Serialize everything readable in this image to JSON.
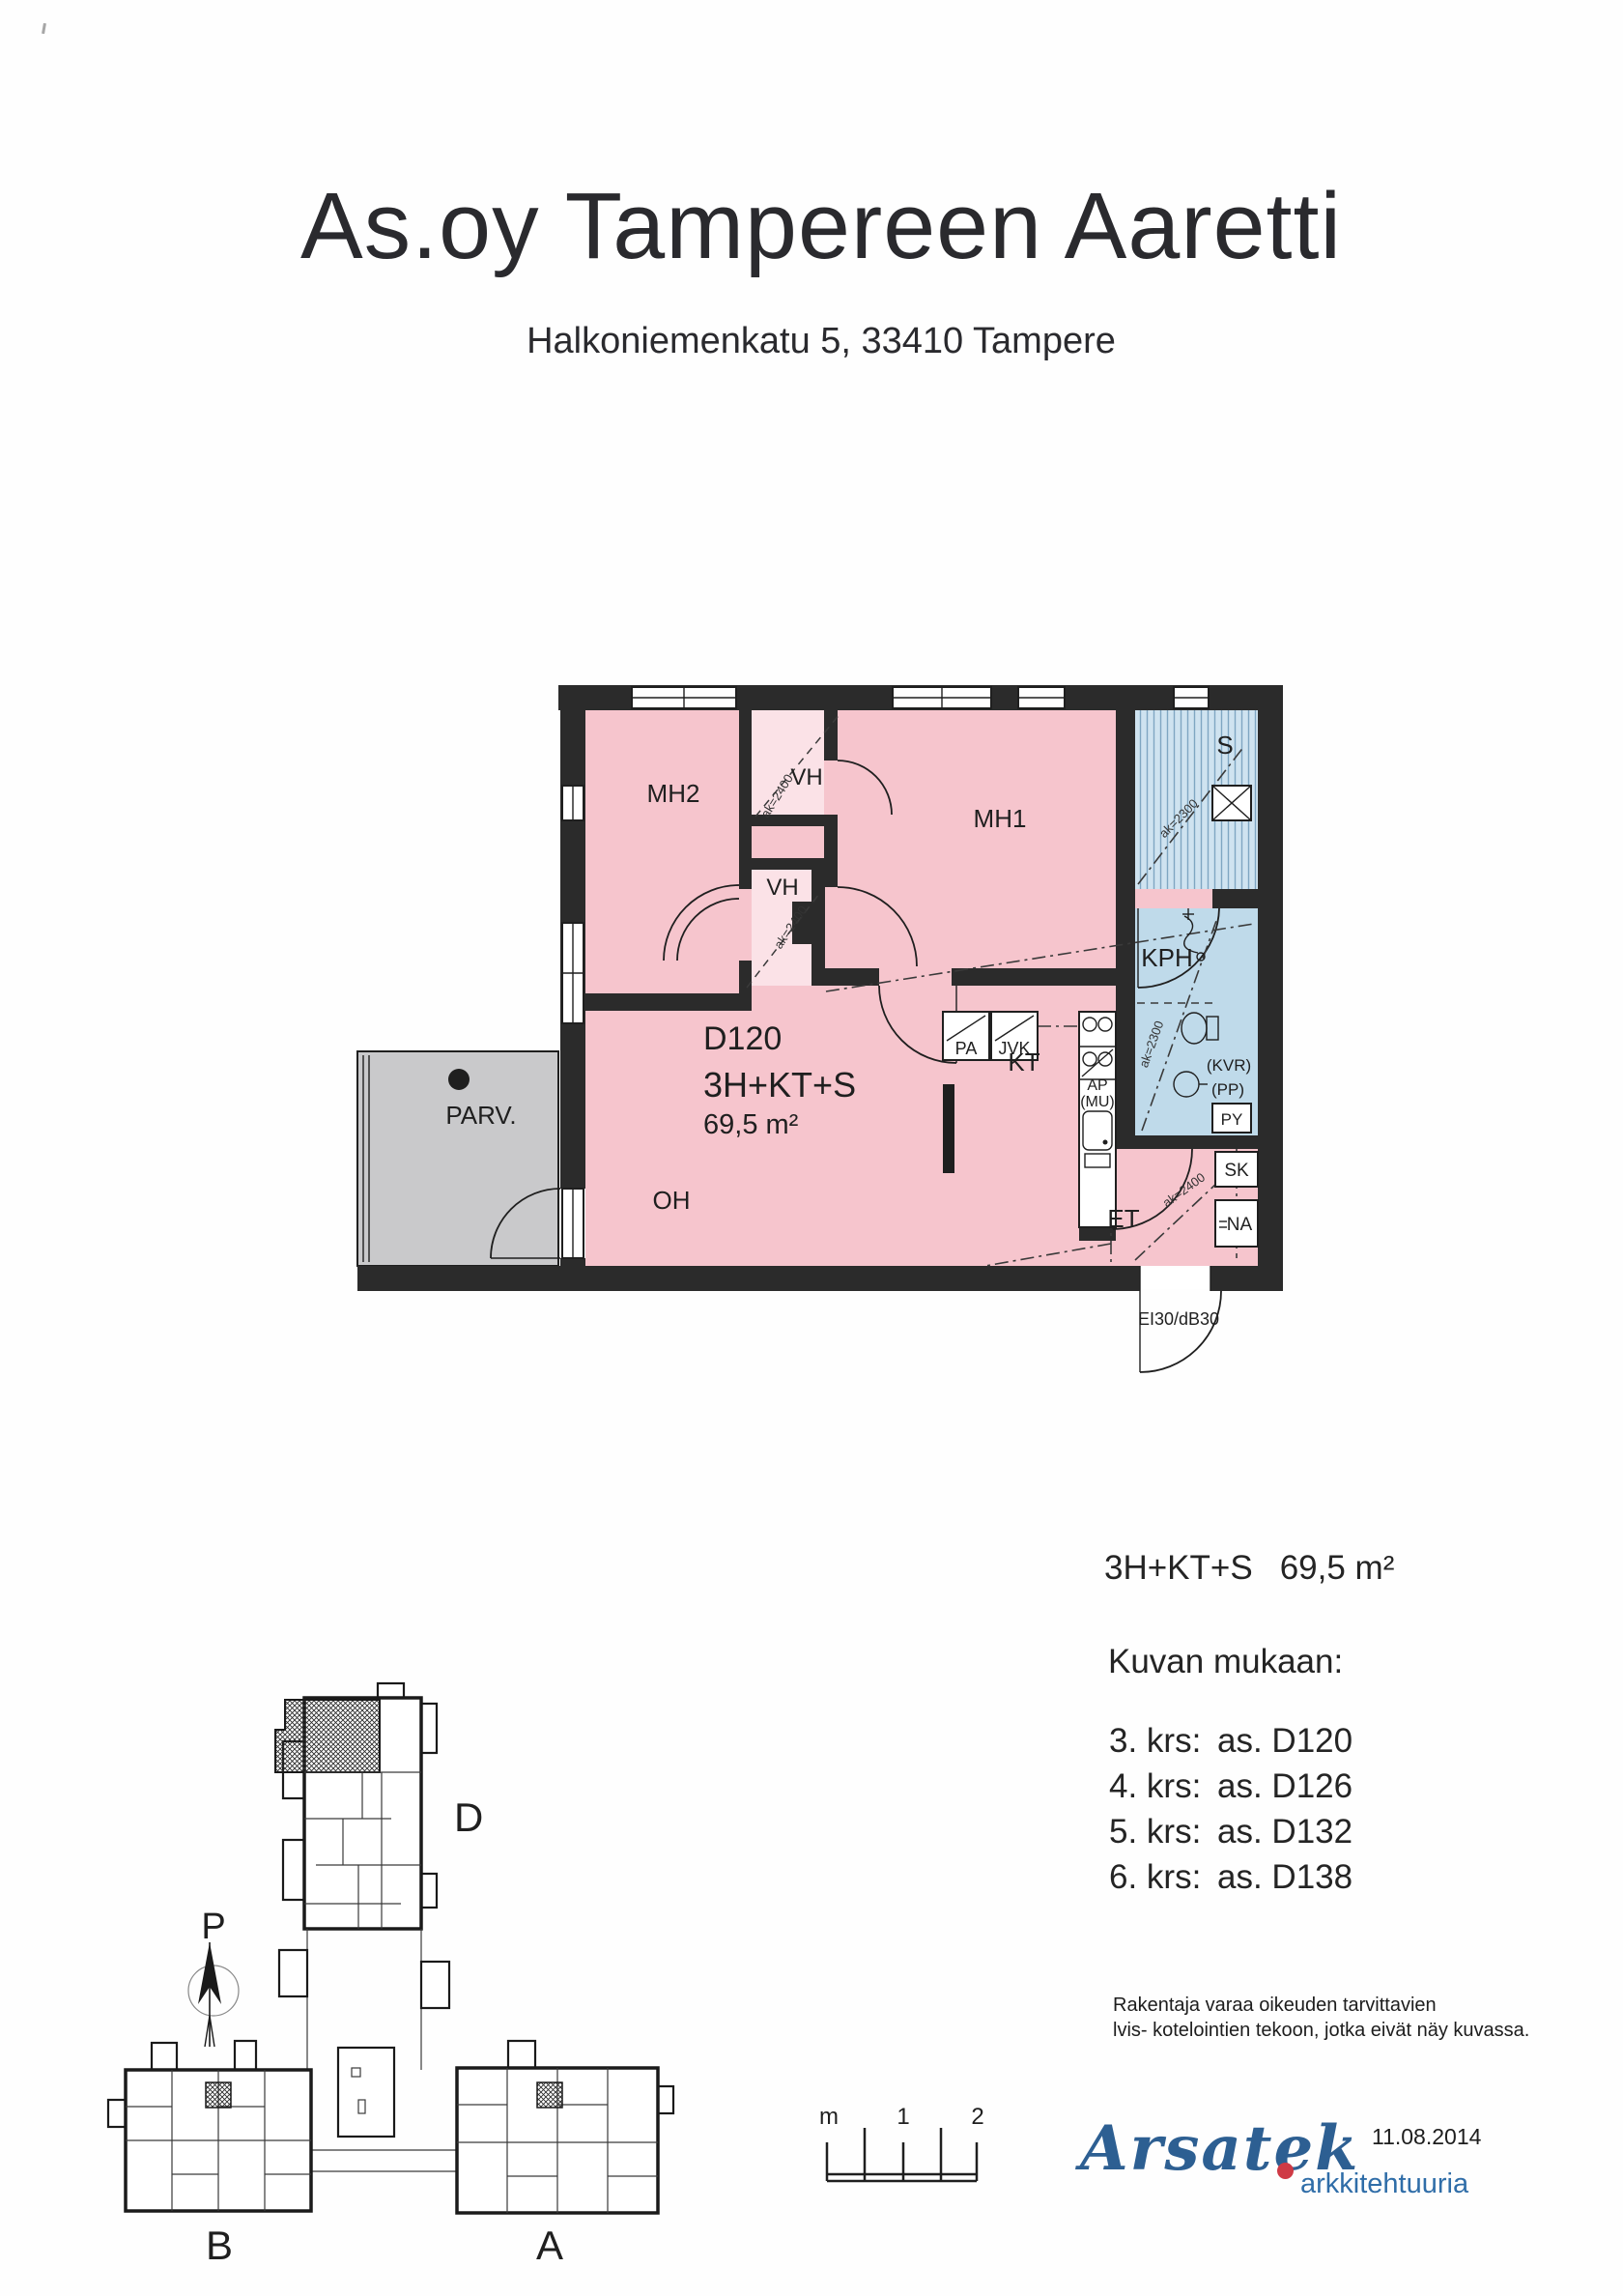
{
  "header": {
    "title": "As.oy Tampereen Aaretti",
    "subtitle": "Halkoniemenkatu 5,  33410 Tampere"
  },
  "floorplan": {
    "unit": "D120",
    "type": "3H+KT+S",
    "area": "69,5 m²",
    "rooms": {
      "mh2": "MH2",
      "mh1": "MH1",
      "vh": "VH",
      "sauna": "S",
      "kph": "KPH",
      "kt": "KT",
      "oh": "OH",
      "et": "ET",
      "parv": "PARV."
    },
    "fixtures": {
      "pa": "PA",
      "jvk": "JVK",
      "ap": "AP",
      "mu": "(MU)",
      "kvr": "(KVR)",
      "pp": "(PP)",
      "py": "PY",
      "sk": "SK",
      "na": "NA"
    },
    "heights": {
      "ak2400": "ak=2400",
      "ak2300": "ak=2300"
    },
    "door_label": "EI30/dB30",
    "colors": {
      "pink": "#f6c5cd",
      "pink_light": "#fbe2e7",
      "blue": "#bfdaea",
      "blue_sauna": "#cfe3f0",
      "gray_balcony": "#c9c9cb",
      "wall": "#2b2b2b",
      "logo_blue": "#2d5f92",
      "logo_red": "#cf3a45"
    }
  },
  "site_plan": {
    "wing_d": "D",
    "wing_a": "A",
    "wing_b": "B",
    "north": "P"
  },
  "info": {
    "summary_type": "3H+KT+S",
    "summary_area": "69,5 m²",
    "heading": "Kuvan mukaan:",
    "floors": [
      {
        "f": "3. krs:",
        "u": "as. D120"
      },
      {
        "f": "4. krs:",
        "u": "as. D126"
      },
      {
        "f": "5. krs:",
        "u": "as. D132"
      },
      {
        "f": "6. krs:",
        "u": "as. D138"
      }
    ],
    "note1": "Rakentaja varaa oikeuden tarvittavien",
    "note2": "lvis- kotelointien tekoon, jotka eivät näy kuvassa."
  },
  "scale_bar": {
    "unit": "m",
    "one": "1",
    "two": "2"
  },
  "footer": {
    "brand": "Arsatek",
    "tagline": "arkkitehtuuria",
    "date": "11.08.2014"
  }
}
